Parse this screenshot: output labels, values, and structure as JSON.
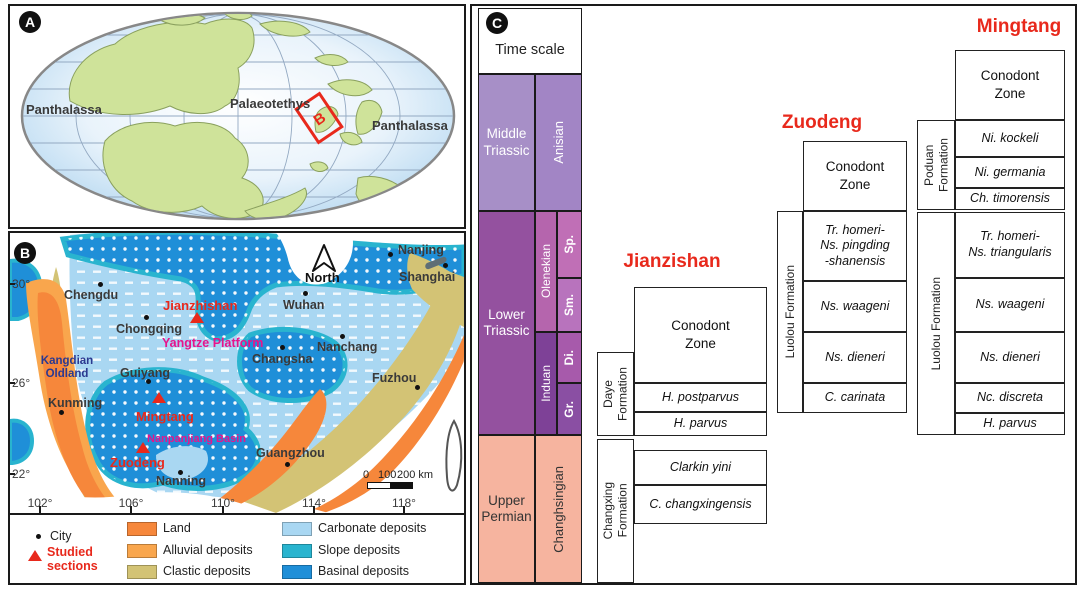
{
  "palette": {
    "border": "#1a1a1a",
    "section_title_red": "#e8291c",
    "magenta_label": "#e6148c",
    "navy_label": "#2b3990",
    "middle_triassic": "#a78fc7",
    "anisian": "#a285c5",
    "lower_triassic": "#94519f",
    "olenekian": "#b565ad",
    "sp": "#c06fb6",
    "sm": "#b873bd",
    "di": "#a75aab",
    "gr": "#8a4fa3",
    "induan": "#7e4197",
    "upper_permian": "#f6b49f",
    "land": "#f6873b",
    "alluvial": "#f9a64d",
    "clastic": "#d3c375",
    "carbonate": "#a9d7f2",
    "slope": "#29b4cf",
    "basinal": "#1f8fd8"
  },
  "panelA": {
    "badge": "A",
    "ocean_left": "Panthalassa",
    "sea": "Palaeotethys",
    "ocean_right": "Panthalassa",
    "inset_label": "B"
  },
  "panelB": {
    "badge": "B",
    "north_label": "North",
    "cities": [
      {
        "name": "Chengdu",
        "dot": [
          100,
          284
        ],
        "label": [
          64,
          288
        ]
      },
      {
        "name": "Chongqing",
        "dot": [
          146,
          317
        ],
        "label": [
          116,
          322
        ]
      },
      {
        "name": "Wuhan",
        "dot": [
          305,
          293
        ],
        "label": [
          283,
          298
        ]
      },
      {
        "name": "Nanjing",
        "dot": [
          390,
          254
        ],
        "label": [
          398,
          243
        ]
      },
      {
        "name": "Shanghai",
        "dot": [
          445,
          265
        ],
        "label": [
          399,
          270
        ]
      },
      {
        "name": "Nanchang",
        "dot": [
          342,
          336
        ],
        "label": [
          317,
          340
        ]
      },
      {
        "name": "Changsha",
        "dot": [
          282,
          347
        ],
        "label": [
          252,
          352
        ]
      },
      {
        "name": "Guiyang",
        "dot": [
          148,
          381
        ],
        "label": [
          120,
          366
        ]
      },
      {
        "name": "Kunming",
        "dot": [
          61,
          412
        ],
        "label": [
          48,
          396
        ]
      },
      {
        "name": "Fuzhou",
        "dot": [
          417,
          387
        ],
        "label": [
          372,
          371
        ]
      },
      {
        "name": "Guangzhou",
        "dot": [
          287,
          464
        ],
        "label": [
          256,
          446
        ]
      },
      {
        "name": "Nanning",
        "dot": [
          180,
          472
        ],
        "label": [
          156,
          474
        ]
      }
    ],
    "studied_sections": [
      {
        "name": "Jianzhishan",
        "tri": [
          190,
          312
        ],
        "label": [
          163,
          298
        ]
      },
      {
        "name": "Mingtang",
        "tri": [
          152,
          392
        ],
        "label": [
          136,
          409
        ]
      },
      {
        "name": "Zuodeng",
        "tri": [
          136,
          442
        ],
        "label": [
          110,
          455
        ]
      }
    ],
    "regions": [
      {
        "name": "Yangtze Platform",
        "pos": [
          162,
          336
        ],
        "cls": "magenta",
        "size": 12.5
      },
      {
        "name": "Nanpanjiang Basin",
        "pos": [
          147,
          433
        ],
        "cls": "magenta",
        "size": 11
      },
      {
        "name": "Kangdian\nOldland",
        "pos": [
          36,
          355
        ],
        "cls": "navy",
        "size": 11.5,
        "w": 62
      }
    ],
    "lat_labels": [
      {
        "t": "30°",
        "y": 277
      },
      {
        "t": "26°",
        "y": 376
      },
      {
        "t": "22°",
        "y": 467
      }
    ],
    "lon_labels": [
      {
        "t": "102°",
        "x": 40
      },
      {
        "t": "106°",
        "x": 131
      },
      {
        "t": "110°",
        "x": 223
      },
      {
        "t": "114°",
        "x": 314
      },
      {
        "t": "118°",
        "x": 404
      }
    ],
    "scalebar": {
      "t0": "0",
      "t1": "100",
      "t2": "200 km"
    },
    "legend": {
      "city": "City",
      "studied": "Studied\nsections",
      "items": [
        {
          "label": "Land",
          "type": "solid",
          "color": "#f6873b"
        },
        {
          "label": "Alluvial deposits",
          "type": "solid",
          "color": "#f9a64d"
        },
        {
          "label": "Clastic deposits",
          "type": "solid",
          "color": "#d3c375"
        },
        {
          "label": "Carbonate deposits",
          "type": "dashes",
          "color": "#a9d7f2"
        },
        {
          "label": "Slope deposits",
          "type": "dots",
          "color": "#29b4cf"
        },
        {
          "label": "Basinal deposits",
          "type": "dots",
          "color": "#1f8fd8"
        }
      ]
    }
  },
  "panelC": {
    "badge": "C",
    "header": "Time scale",
    "time_scale": {
      "middle_triassic": "Middle\nTriassic",
      "anisian": "Anisian",
      "lower_triassic": "Lower\nTriassic",
      "olenekian": "Olenekian",
      "induan": "Induan",
      "sp": "Sp.",
      "sm": "Sm.",
      "di": "Di.",
      "gr": "Gr.",
      "upper_permian": "Upper\nPermian",
      "changhsingian": "Changhsingian"
    },
    "sections": {
      "jianzishan": {
        "title": "Jianzishan",
        "zone_header": "Conodont\nZone",
        "formations": {
          "daye": "Daye\nFormation",
          "changxing": "Changxing\nFormation"
        },
        "zones": {
          "postparvus": "H. postparvus",
          "parvus": "H. parvus",
          "clarkin": "Clarkin yini",
          "changxingensis": "C. changxingensis"
        }
      },
      "zuodeng": {
        "title": "Zuodeng",
        "zone_header": "Conodont\nZone",
        "formations": {
          "luolou": "Luolou Formation"
        },
        "zones": {
          "homeri": "Tr. homeri-\nNs. pingding\n-shanensis",
          "waageni": "Ns. waageni",
          "dieneri": "Ns. dieneri",
          "carinata": "C. carinata"
        }
      },
      "mingtang": {
        "title": "Mingtang",
        "zone_header": "Conodont\nZone",
        "formations": {
          "poduan": "Poduan\nFormation",
          "luolou": "Luolou Formation"
        },
        "zones": {
          "kockeli": "Ni. kockeli",
          "germania": "Ni. germania",
          "timorensis": "Ch. timorensis",
          "homeri": "Tr. homeri-\nNs. triangularis",
          "waageni": "Ns. waageni",
          "dieneri": "Ns. dieneri",
          "discreta": "Nc. discreta",
          "parvus": "H. parvus"
        }
      }
    }
  }
}
